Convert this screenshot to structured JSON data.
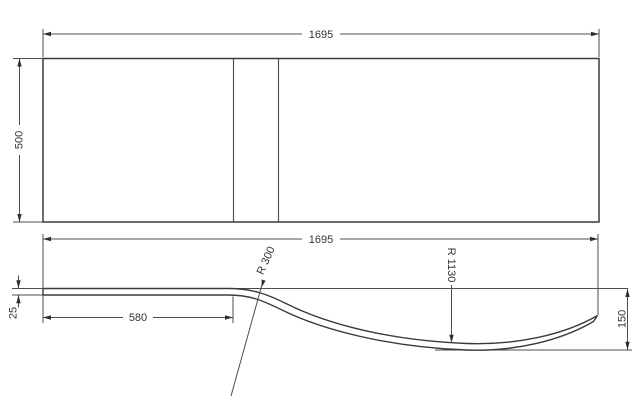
{
  "title": "Bath panel technical drawing",
  "colors": {
    "background": "#ffffff",
    "outline": "#3a3a3a",
    "dimension_lines": "#4d4d4d",
    "text": "#333333"
  },
  "top_view": {
    "width_dim": "1695",
    "height_dim": "500"
  },
  "profile_view": {
    "width_dim": "1695",
    "flat_section_dim": "580",
    "thickness_dim": "25",
    "end_height_dim": "150",
    "small_radius_dim": "R 300",
    "large_radius_dim": "R 1130"
  }
}
